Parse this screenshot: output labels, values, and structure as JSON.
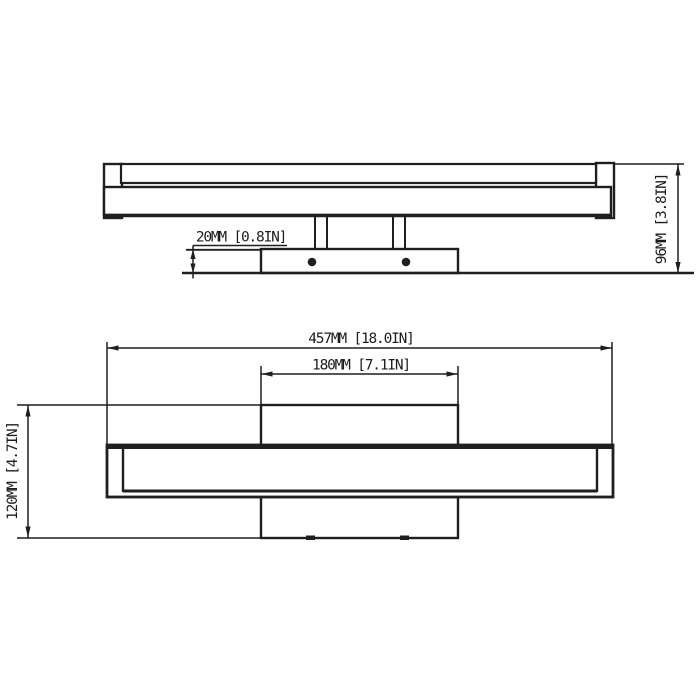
{
  "meta": {
    "background_color": "#ffffff",
    "line_color": "#1f1f1f",
    "drawing_type": "fixture-dimension-drawing"
  },
  "front_view": {
    "dim_plate_thickness": "20MM [0.8IN]",
    "dim_fixture_height": "96MM [3.8IN]"
  },
  "plan_view": {
    "dim_overall_length": "457MM [18.0IN]",
    "dim_backplate_length": "180MM [7.1IN]",
    "dim_fixture_depth": "120MM [4.7IN]"
  }
}
